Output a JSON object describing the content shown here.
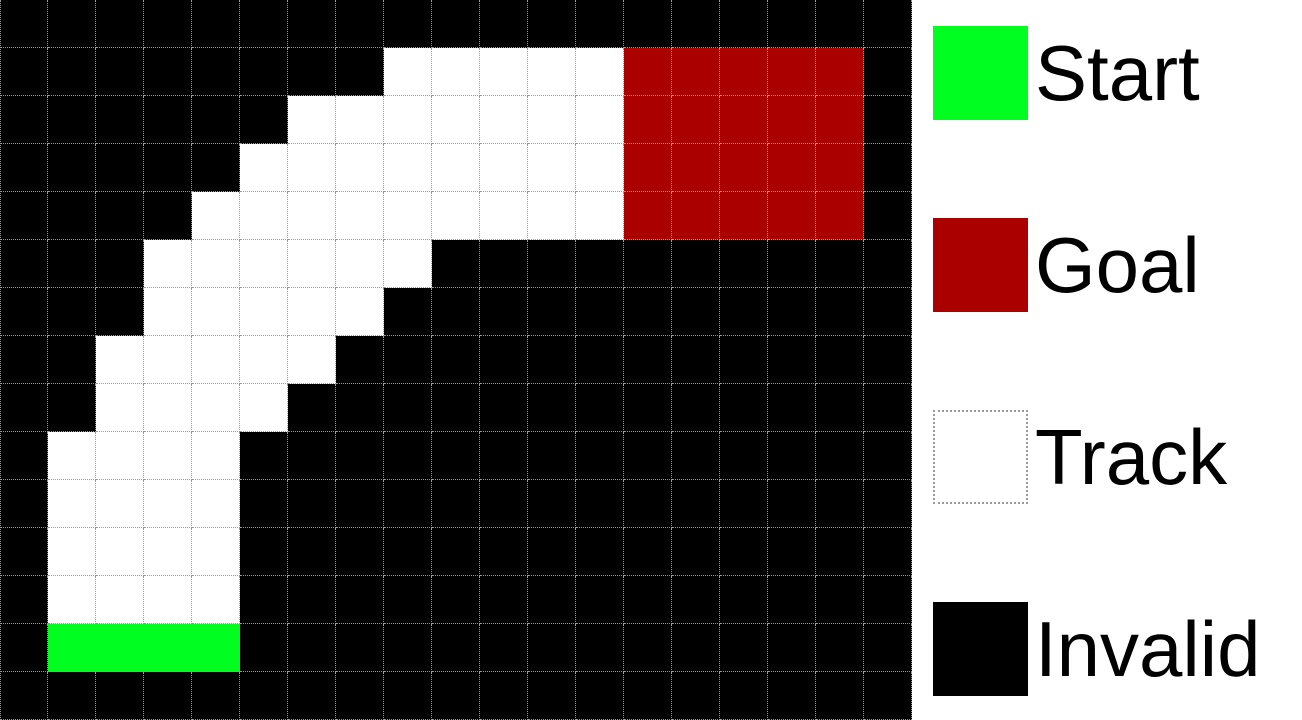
{
  "grid": {
    "cols": 19,
    "rows": 15,
    "cell_size_px": 48,
    "legend_keys": {
      "#": "invalid",
      ".": "track",
      "S": "start",
      "G": "goal"
    },
    "palette": {
      "invalid": "#000000",
      "track": "#ffffff",
      "start": "#00FF21",
      "goal": "#AA0000",
      "gridline": "#9a9a9a"
    },
    "rows_map": [
      "###################",
      "########.....GGGGG#",
      "######.......GGGGG#",
      "#####........GGGGG#",
      "####.........GGGGG#",
      "###......##########",
      "###.....###########",
      "##.....############",
      "##....#############",
      "#....##############",
      "#....##############",
      "#....##############",
      "#....##############",
      "#SSSS##############",
      "###################"
    ]
  },
  "legend": {
    "items": [
      {
        "id": "start",
        "label": "Start",
        "swatch_color": "#00FF21",
        "swatch_style": "solid"
      },
      {
        "id": "goal",
        "label": "Goal",
        "swatch_color": "#AA0000",
        "swatch_style": "solid"
      },
      {
        "id": "track",
        "label": "Track",
        "swatch_color": "#ffffff",
        "swatch_style": "dotted-border"
      },
      {
        "id": "invalid",
        "label": "Invalid",
        "swatch_color": "#000000",
        "swatch_style": "solid"
      }
    ]
  }
}
